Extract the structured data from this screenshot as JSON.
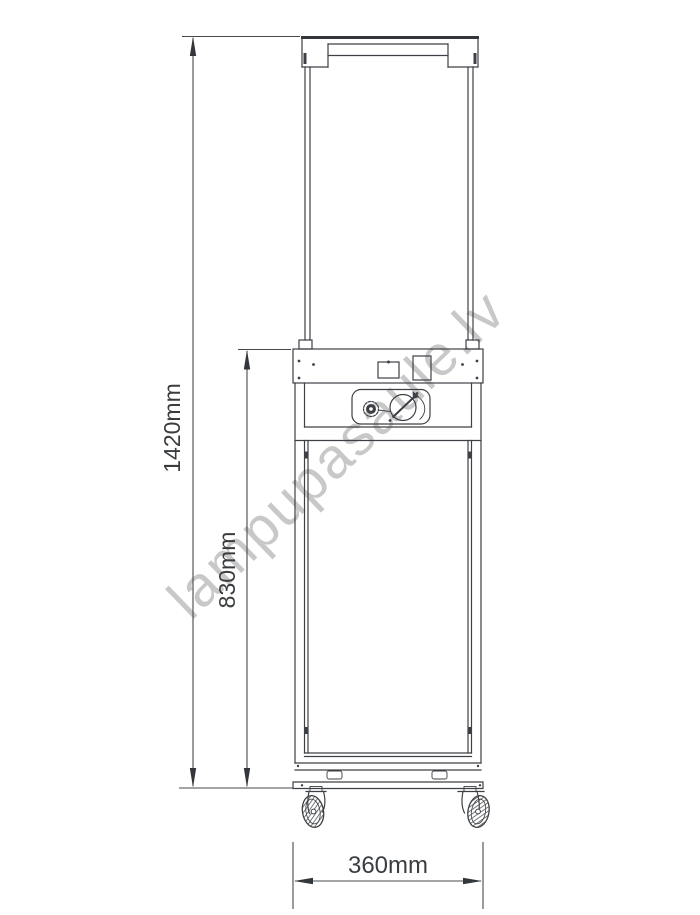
{
  "watermark": {
    "text": "lampupasaule.lv",
    "color": "#c6c6c6"
  },
  "dimensions": {
    "overall_height": {
      "label": "1420mm"
    },
    "body_height": {
      "label": "830mm"
    },
    "width": {
      "label": "360mm"
    }
  },
  "colors": {
    "line": "#3d4045",
    "background": "#ffffff"
  }
}
